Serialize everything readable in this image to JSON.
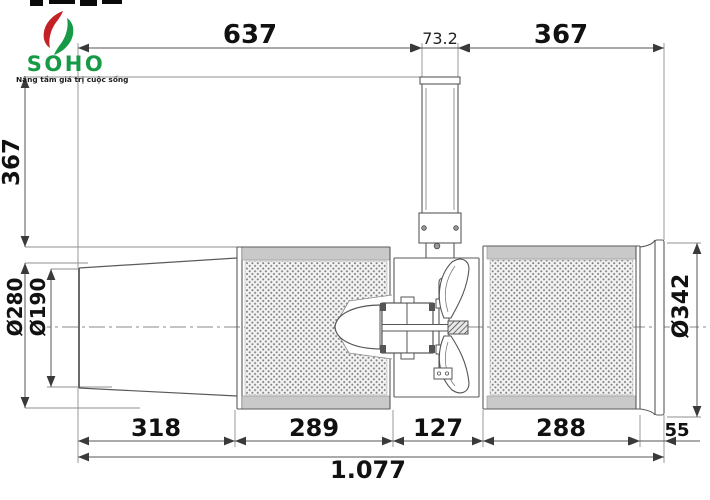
{
  "logo": {
    "wordmark": "SOHO",
    "tagline": "Nâng tầm giá trị cuộc sống",
    "brand_green": "#169a46",
    "brand_red": "#c42127"
  },
  "drawing": {
    "type": "jet-fan side-view technical drawing",
    "dims": {
      "length_inlet_to_bracket": "637",
      "bracket_width": "73.2",
      "length_bracket_to_outlet": "367",
      "bracket_height": "367",
      "inlet_cone_diameter": "Ø280",
      "inlet_opening_diameter": "Ø190",
      "outlet_flange_diameter": "Ø342",
      "inlet_cone_length": "318",
      "left_silencer_length": "289",
      "fan_section_length": "127",
      "right_silencer_length": "288",
      "outlet_flange_length": "55",
      "total_length": "1.077"
    }
  }
}
